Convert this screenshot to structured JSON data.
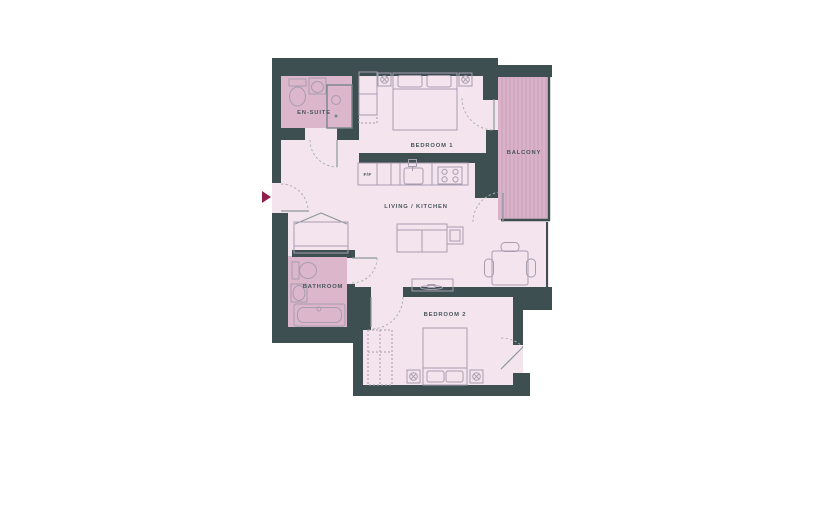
{
  "canvas": {
    "width": 825,
    "height": 510,
    "background": "#ffffff"
  },
  "palette": {
    "wall": "#3d4f50",
    "floor": "#f4e4ee",
    "wet_room": "#dcb6ca",
    "balcony_fill": "#d9b2c8",
    "balcony_stripe": "#c9a2bd",
    "furniture_outline": "#a79db0",
    "label_text": "#46555a",
    "entry_arrow": "#8e2050"
  },
  "floorplan": {
    "rooms": {
      "ensuite": {
        "label": "EN-SUITE"
      },
      "bedroom1": {
        "label": "BEDROOM 1"
      },
      "balcony": {
        "label": "BALCONY"
      },
      "living_kitchen": {
        "label": "LIVING / KITCHEN"
      },
      "bathroom": {
        "label": "BATHROOM"
      },
      "bedroom2": {
        "label": "BEDROOM 2"
      }
    },
    "appliances": {
      "fridge_freezer": {
        "label": "F/F"
      }
    },
    "entry": {
      "marker": "entry-arrow"
    }
  }
}
